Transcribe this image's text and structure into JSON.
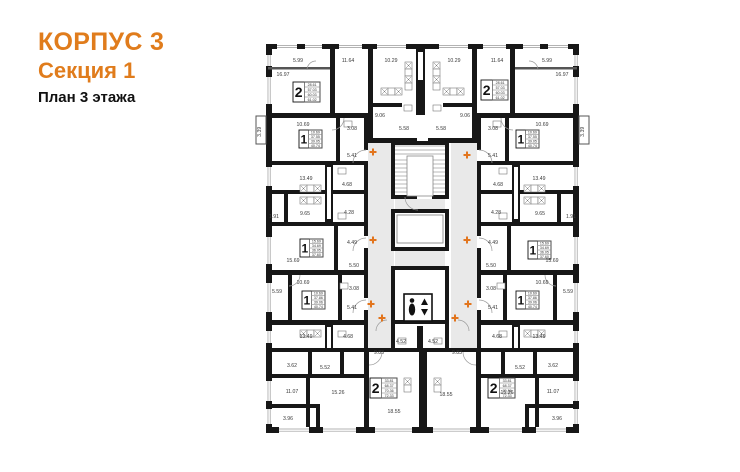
{
  "header": {
    "building": "КОРПУС 3",
    "section": "Секция 1",
    "plan_title": "План 3 этажа"
  },
  "colors": {
    "accent_orange": "#E07C1C",
    "marker_orange": "#E2751D",
    "wall": "#171717",
    "corridor_gray": "#E9E9E9",
    "label_gray": "#3a3a3a"
  },
  "plan": {
    "width": 740,
    "height": 472,
    "mirror_x": 845,
    "walls": [
      [
        266,
        44,
        313,
        5,
        0
      ],
      [
        266,
        427,
        313,
        6,
        0
      ],
      [
        266,
        44,
        6,
        389,
        1
      ],
      [
        330,
        49,
        5,
        69,
        1
      ],
      [
        368,
        49,
        5,
        94,
        1
      ],
      [
        266,
        113,
        106,
        5,
        1
      ],
      [
        368,
        138,
        49,
        5,
        1
      ],
      [
        416,
        49,
        9,
        66,
        0
      ],
      [
        372,
        103,
        30,
        4,
        1
      ],
      [
        336,
        118,
        4,
        46,
        1
      ],
      [
        266,
        161,
        102,
        4,
        1
      ],
      [
        325,
        164,
        8,
        58,
        1
      ],
      [
        266,
        190,
        102,
        4,
        1
      ],
      [
        266,
        222,
        102,
        4,
        1
      ],
      [
        284,
        194,
        4,
        28,
        1
      ],
      [
        334,
        226,
        4,
        46,
        1
      ],
      [
        266,
        270,
        102,
        5,
        1
      ],
      [
        288,
        275,
        4,
        45,
        1
      ],
      [
        338,
        275,
        4,
        45,
        1
      ],
      [
        266,
        320,
        102,
        5,
        1
      ],
      [
        325,
        325,
        8,
        25,
        1
      ],
      [
        266,
        348,
        313,
        4,
        0
      ],
      [
        308,
        352,
        4,
        24,
        1
      ],
      [
        340,
        352,
        4,
        24,
        1
      ],
      [
        266,
        374,
        102,
        4,
        1
      ],
      [
        306,
        378,
        4,
        49,
        1
      ],
      [
        364,
        352,
        5,
        75,
        1
      ],
      [
        266,
        404,
        54,
        4,
        1
      ],
      [
        316,
        404,
        4,
        23,
        1
      ],
      [
        419,
        352,
        8,
        81,
        0
      ],
      [
        364,
        118,
        4,
        32,
        1
      ],
      [
        364,
        162,
        4,
        74,
        1
      ],
      [
        364,
        248,
        4,
        50,
        1
      ],
      [
        364,
        310,
        4,
        42,
        1
      ],
      [
        391,
        141,
        58,
        4,
        0
      ],
      [
        391,
        195,
        26,
        4,
        0
      ],
      [
        432,
        195,
        17,
        4,
        0
      ],
      [
        391,
        141,
        4,
        58,
        0
      ],
      [
        445,
        141,
        4,
        58,
        0
      ],
      [
        391,
        209,
        58,
        4,
        0
      ],
      [
        391,
        247,
        58,
        4,
        0
      ],
      [
        391,
        209,
        4,
        42,
        0
      ],
      [
        445,
        209,
        4,
        42,
        0
      ],
      [
        391,
        266,
        58,
        4,
        0
      ],
      [
        391,
        320,
        58,
        4,
        0
      ],
      [
        391,
        266,
        4,
        58,
        0
      ],
      [
        445,
        266,
        4,
        58,
        0
      ],
      [
        391,
        324,
        4,
        26,
        0
      ],
      [
        445,
        324,
        4,
        26,
        0
      ],
      [
        417,
        326,
        6,
        24,
        0
      ]
    ],
    "grays": [
      [
        368,
        143,
        26,
        205,
        1
      ],
      [
        395,
        199,
        50,
        10,
        0
      ],
      [
        395,
        251,
        50,
        15,
        0
      ]
    ],
    "windows": [
      [
        277,
        44,
        20,
        5,
        1
      ],
      [
        305,
        44,
        17,
        5,
        1
      ],
      [
        339,
        44,
        23,
        5,
        1
      ],
      [
        377,
        44,
        29,
        5,
        1
      ],
      [
        279,
        427,
        30,
        6,
        1
      ],
      [
        323,
        427,
        33,
        6,
        1
      ],
      [
        375,
        427,
        37,
        6,
        1
      ],
      [
        266,
        55,
        6,
        11,
        1
      ],
      [
        266,
        77,
        6,
        27,
        1
      ],
      [
        266,
        167,
        6,
        19,
        1
      ],
      [
        266,
        237,
        6,
        27,
        1
      ],
      [
        266,
        283,
        6,
        29,
        1
      ],
      [
        266,
        331,
        6,
        12,
        1
      ],
      [
        266,
        381,
        6,
        20,
        1
      ],
      [
        266,
        409,
        6,
        15,
        1
      ]
    ],
    "thin_walls": [
      [
        268,
        67,
        62,
        2.5,
        1
      ]
    ],
    "balcony_boxes": [
      [
        256,
        116,
        10,
        28,
        1
      ]
    ],
    "slots": [
      [
        327,
        167,
        4,
        52,
        1
      ],
      [
        327,
        327,
        4,
        21,
        1
      ],
      [
        418,
        52,
        5,
        28,
        0
      ]
    ],
    "stairs": {
      "box": [
        395,
        145,
        50,
        50
      ],
      "inner": [
        407,
        156,
        26,
        40
      ],
      "top_lines_y": [
        146,
        150,
        154
      ],
      "col_step": 4,
      "col_from": 160,
      "col_to": 192
    },
    "elevator_cab": [
      397,
      215,
      46,
      28
    ],
    "elevator_icon": {
      "x": 404,
      "y": 294,
      "w": 28,
      "h": 27
    },
    "grids": [
      [
        405,
        62,
        7,
        4,
        "v",
        1
      ],
      [
        381,
        88,
        7,
        3,
        "h",
        1
      ],
      [
        300,
        185,
        7,
        3,
        "h",
        1
      ],
      [
        300,
        197,
        7,
        3,
        "h",
        1
      ],
      [
        300,
        330,
        7,
        3,
        "h",
        1
      ],
      [
        404,
        378,
        7,
        2,
        "v",
        1
      ]
    ],
    "fixtures": [
      [
        338,
        168,
        8,
        6,
        1
      ],
      [
        338,
        213,
        8,
        6,
        1
      ],
      [
        344,
        121,
        8,
        6,
        1
      ],
      [
        404,
        105,
        8,
        6,
        1
      ],
      [
        340,
        283,
        8,
        6,
        1
      ],
      [
        338,
        331,
        8,
        6,
        1
      ],
      [
        398,
        338,
        8,
        6,
        0
      ],
      [
        434,
        338,
        8,
        6,
        0
      ]
    ],
    "arcs": [
      [
        366,
        163,
        13,
        270,
        180,
        1
      ],
      [
        366,
        251,
        13,
        270,
        180,
        1
      ],
      [
        366,
        313,
        13,
        270,
        180,
        1
      ],
      [
        387,
        331,
        11,
        270,
        180,
        1
      ],
      [
        316,
        70,
        9,
        180,
        270,
        1
      ],
      [
        418,
        197,
        13,
        90,
        180,
        0
      ],
      [
        332,
        118,
        12,
        0,
        90,
        1
      ],
      [
        369,
        352,
        13,
        0,
        90,
        1
      ],
      [
        289,
        275,
        11,
        0,
        90,
        1
      ]
    ],
    "crosses": [
      [
        373,
        152
      ],
      [
        467,
        155
      ],
      [
        373,
        240
      ],
      [
        467,
        240
      ],
      [
        371,
        304
      ],
      [
        468,
        304
      ],
      [
        382,
        318
      ],
      [
        455,
        318
      ]
    ],
    "labels": [
      [
        298,
        60,
        "5.99",
        1,
        0
      ],
      [
        283,
        74,
        "16.97",
        1,
        0
      ],
      [
        348,
        60,
        "11.64",
        1,
        0
      ],
      [
        391,
        60,
        "10.29",
        1,
        0
      ],
      [
        380,
        115,
        "9.06",
        1,
        0
      ],
      [
        404,
        128,
        "5.58",
        1,
        0
      ],
      [
        261,
        130,
        "3.39",
        1,
        1
      ],
      [
        303,
        124,
        "10.69",
        1,
        0
      ],
      [
        352,
        128,
        "3.08",
        1,
        0
      ],
      [
        352,
        155,
        "5.41",
        1,
        0
      ],
      [
        306,
        178,
        "13.49",
        1,
        0
      ],
      [
        347,
        184,
        "4.68",
        1,
        0
      ],
      [
        305,
        213,
        "9.65",
        1,
        0
      ],
      [
        349,
        212,
        "4.28",
        1,
        0
      ],
      [
        274,
        216,
        "1.91",
        1,
        0
      ],
      [
        352,
        242,
        "4.49",
        1,
        0
      ],
      [
        293,
        260,
        "15.69",
        1,
        0
      ],
      [
        354,
        265,
        "5.50",
        1,
        0
      ],
      [
        303,
        282,
        "10.69",
        1,
        0
      ],
      [
        277,
        291,
        "5.59",
        1,
        0
      ],
      [
        354,
        288,
        "3.08",
        1,
        0
      ],
      [
        352,
        307,
        "5.41",
        1,
        0
      ],
      [
        306,
        336,
        "13.49",
        1,
        0
      ],
      [
        348,
        336,
        "4.68",
        1,
        0
      ],
      [
        292,
        365,
        "3.62",
        1,
        0
      ],
      [
        325,
        367,
        "5.52",
        1,
        0
      ],
      [
        401,
        341,
        "4.52",
        0,
        0
      ],
      [
        433,
        341,
        "4.52",
        0,
        0
      ],
      [
        379,
        352,
        "9.83",
        0,
        0
      ],
      [
        457,
        352,
        "9.83",
        0,
        0
      ],
      [
        292,
        391,
        "11.07",
        1,
        0
      ],
      [
        338,
        392,
        "15.26",
        1,
        0
      ],
      [
        394,
        411,
        "18.55",
        0,
        0
      ],
      [
        446,
        394,
        "18.55",
        0,
        0
      ],
      [
        288,
        418,
        "3.96",
        1,
        0
      ]
    ],
    "cards": [
      {
        "x": 293,
        "y": 82,
        "w": 27,
        "h": 20,
        "n": "2",
        "rows": [
          "28.61",
          "57.03",
          "60.03",
          "61.02"
        ]
      },
      {
        "x": 481,
        "y": 80,
        "w": 27,
        "h": 20,
        "n": "2",
        "rows": [
          "28.61",
          "57.03",
          "60.03",
          "61.02"
        ]
      },
      {
        "x": 299,
        "y": 130,
        "w": 23,
        "h": 18,
        "n": "1",
        "rows": [
          "10.69",
          "37.55",
          "39.05",
          "40.74"
        ]
      },
      {
        "x": 516,
        "y": 130,
        "w": 23,
        "h": 18,
        "n": "1",
        "rows": [
          "10.69",
          "37.55",
          "39.05",
          "40.74"
        ]
      },
      {
        "x": 300,
        "y": 239,
        "w": 23,
        "h": 18,
        "n": "1",
        "rows": [
          "15.69",
          "34.69",
          "36.05",
          "37.60"
        ]
      },
      {
        "x": 528,
        "y": 241,
        "w": 23,
        "h": 18,
        "n": "1",
        "rows": [
          "15.69",
          "34.69",
          "36.05",
          "37.60"
        ]
      },
      {
        "x": 302,
        "y": 291,
        "w": 23,
        "h": 18,
        "n": "1",
        "rows": [
          "10.69",
          "37.86",
          "39.06",
          "40.74"
        ]
      },
      {
        "x": 516,
        "y": 291,
        "w": 23,
        "h": 18,
        "n": "1",
        "rows": [
          "10.69",
          "37.86",
          "39.06",
          "40.74"
        ]
      },
      {
        "x": 370,
        "y": 378,
        "w": 27,
        "h": 20,
        "n": "2",
        "rows": [
          "33.81",
          "68.37",
          "70.36",
          "72.33"
        ]
      },
      {
        "x": 488,
        "y": 378,
        "w": 27,
        "h": 20,
        "n": "2",
        "rows": [
          "33.81",
          "68.37",
          "70.36",
          "72.33"
        ]
      }
    ]
  }
}
